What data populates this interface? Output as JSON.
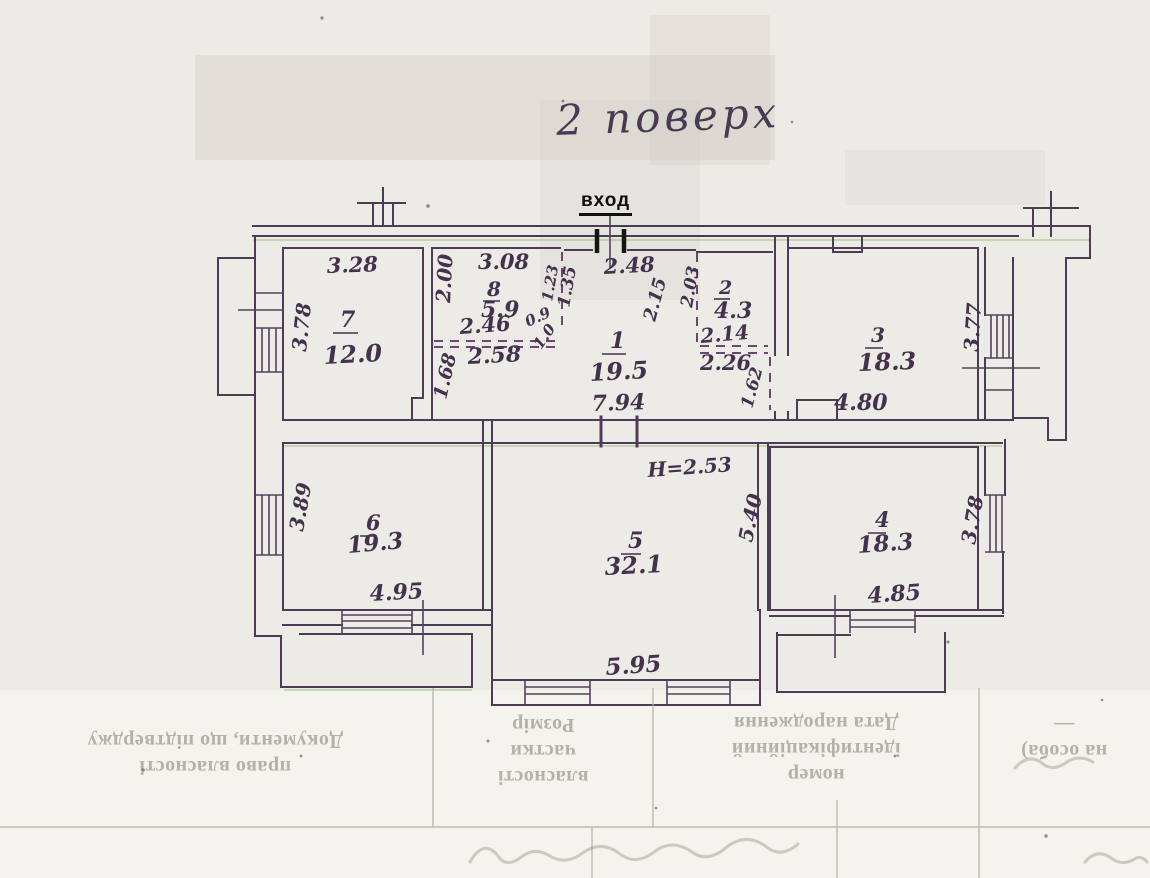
{
  "document": {
    "floor_title": "2 поверх",
    "entrance_label": "вход"
  },
  "colors": {
    "paper": "#edebe5",
    "ink_lines": "#4e3b58",
    "ink_text": "#43314e",
    "entrance_ink": "#0f0f0f",
    "faint_table": "#b6b0a5"
  },
  "plan": {
    "room1": {
      "number": "1",
      "area": "19.5",
      "dim_top": "2.48",
      "dim_bottom": "7.94",
      "dim_v1": "1.23",
      "dim_v2": "1.35",
      "dim_v3": "2.15"
    },
    "room2": {
      "number": "2",
      "area": "4.3",
      "dim_left": "2.03",
      "dim_mid": "2.14",
      "dim_bottom": "2.26",
      "dim_right": "1.62"
    },
    "room3": {
      "number": "3",
      "area": "18.3",
      "dim_bottom": "4.80",
      "dim_right": "3.77"
    },
    "room4": {
      "number": "4",
      "area": "18.3",
      "dim_bottom": "4.85",
      "dim_right": "3.78"
    },
    "room5": {
      "number": "5",
      "area": "32.1",
      "height_note": "Н=2.53",
      "dim_right": "5.40",
      "dim_bottom": "5.95"
    },
    "room6": {
      "number": "6",
      "area": "19.3",
      "dim_left": "3.89",
      "dim_bottom": "4.95"
    },
    "room7": {
      "number": "7",
      "area": "12.0",
      "dim_top": "3.28",
      "dim_left": "3.78"
    },
    "room8": {
      "number": "8",
      "area": "5.9",
      "dim_top": "3.08",
      "dim_left": "2.00",
      "dim_mid1": "2.46",
      "dim_mid2": "2.58",
      "dim_low": "1.68",
      "dim_s1": "0.9",
      "dim_s2": "1.0"
    }
  },
  "table": {
    "col1_line1": "Документи, що підтверджу",
    "col1_line2": "право власності",
    "col2_line1": "Розмір",
    "col2_line2": "частки",
    "col2_line3": "власності",
    "col3_line1": "Дата народження",
    "col3_line2": "ідентифікаційний",
    "col3_line3": "номер",
    "col4_line1": "—",
    "col4_line2": "на особа)"
  }
}
